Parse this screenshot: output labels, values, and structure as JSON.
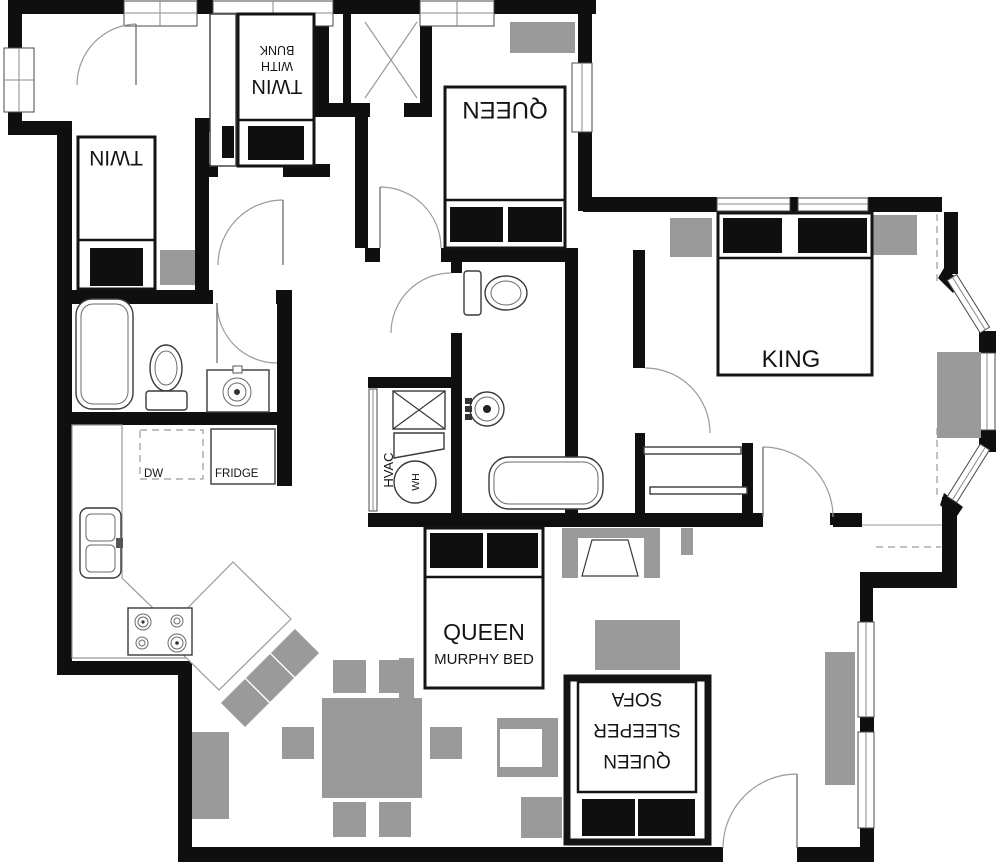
{
  "floor_plan": {
    "colors": {
      "wall": "#0f0f0f",
      "furniture": "#9a9a9a",
      "floor": "#ffffff"
    },
    "labels": {
      "twin_bed": "TWIN",
      "bunk_bed_lines": [
        "TWIN",
        "WITH",
        "BUNK"
      ],
      "queen_bed": "QUEEN",
      "king_bed": "KING",
      "murphy_bed_line1": "QUEEN",
      "murphy_bed_line2": "MURPHY BED",
      "sleeper_sofa_lines": [
        "QUEEN",
        "SLEEPER",
        "SOFA"
      ],
      "dishwasher": "DW",
      "fridge": "FRIDGE",
      "hvac": "HVAC",
      "water_heater": "WH"
    }
  }
}
